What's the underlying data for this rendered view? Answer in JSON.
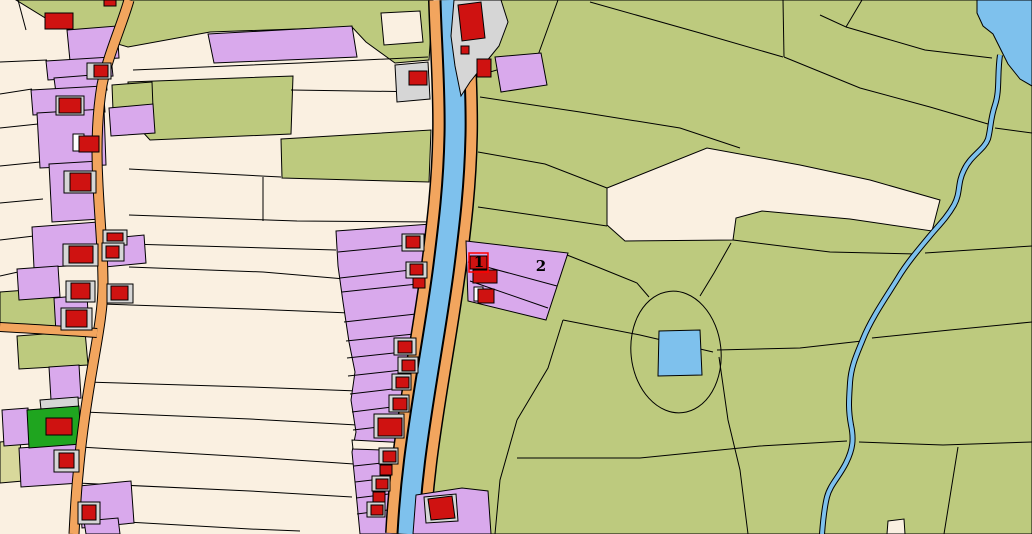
{
  "map": {
    "kind": "cadastral-parcel-map",
    "labels": [
      {
        "text": "1"
      },
      {
        "text": "2"
      }
    ],
    "palette": {
      "parcel-cream": "#faf0e1",
      "parcel-green": "#bdca7e",
      "parcel-purple": "#d9a9ec",
      "parcel-khaki": "#d8d89b",
      "parcel-bright-green": "#1fa51f",
      "farmyard-gray": "#d6d6d6",
      "building-red": "#cf1211",
      "road-orange": "#f2a55e",
      "water-blue": "#7ec1ed",
      "boundary-black": "#000000",
      "highlight-red": "#ff0000",
      "highlight-white": "#ffffff"
    }
  }
}
